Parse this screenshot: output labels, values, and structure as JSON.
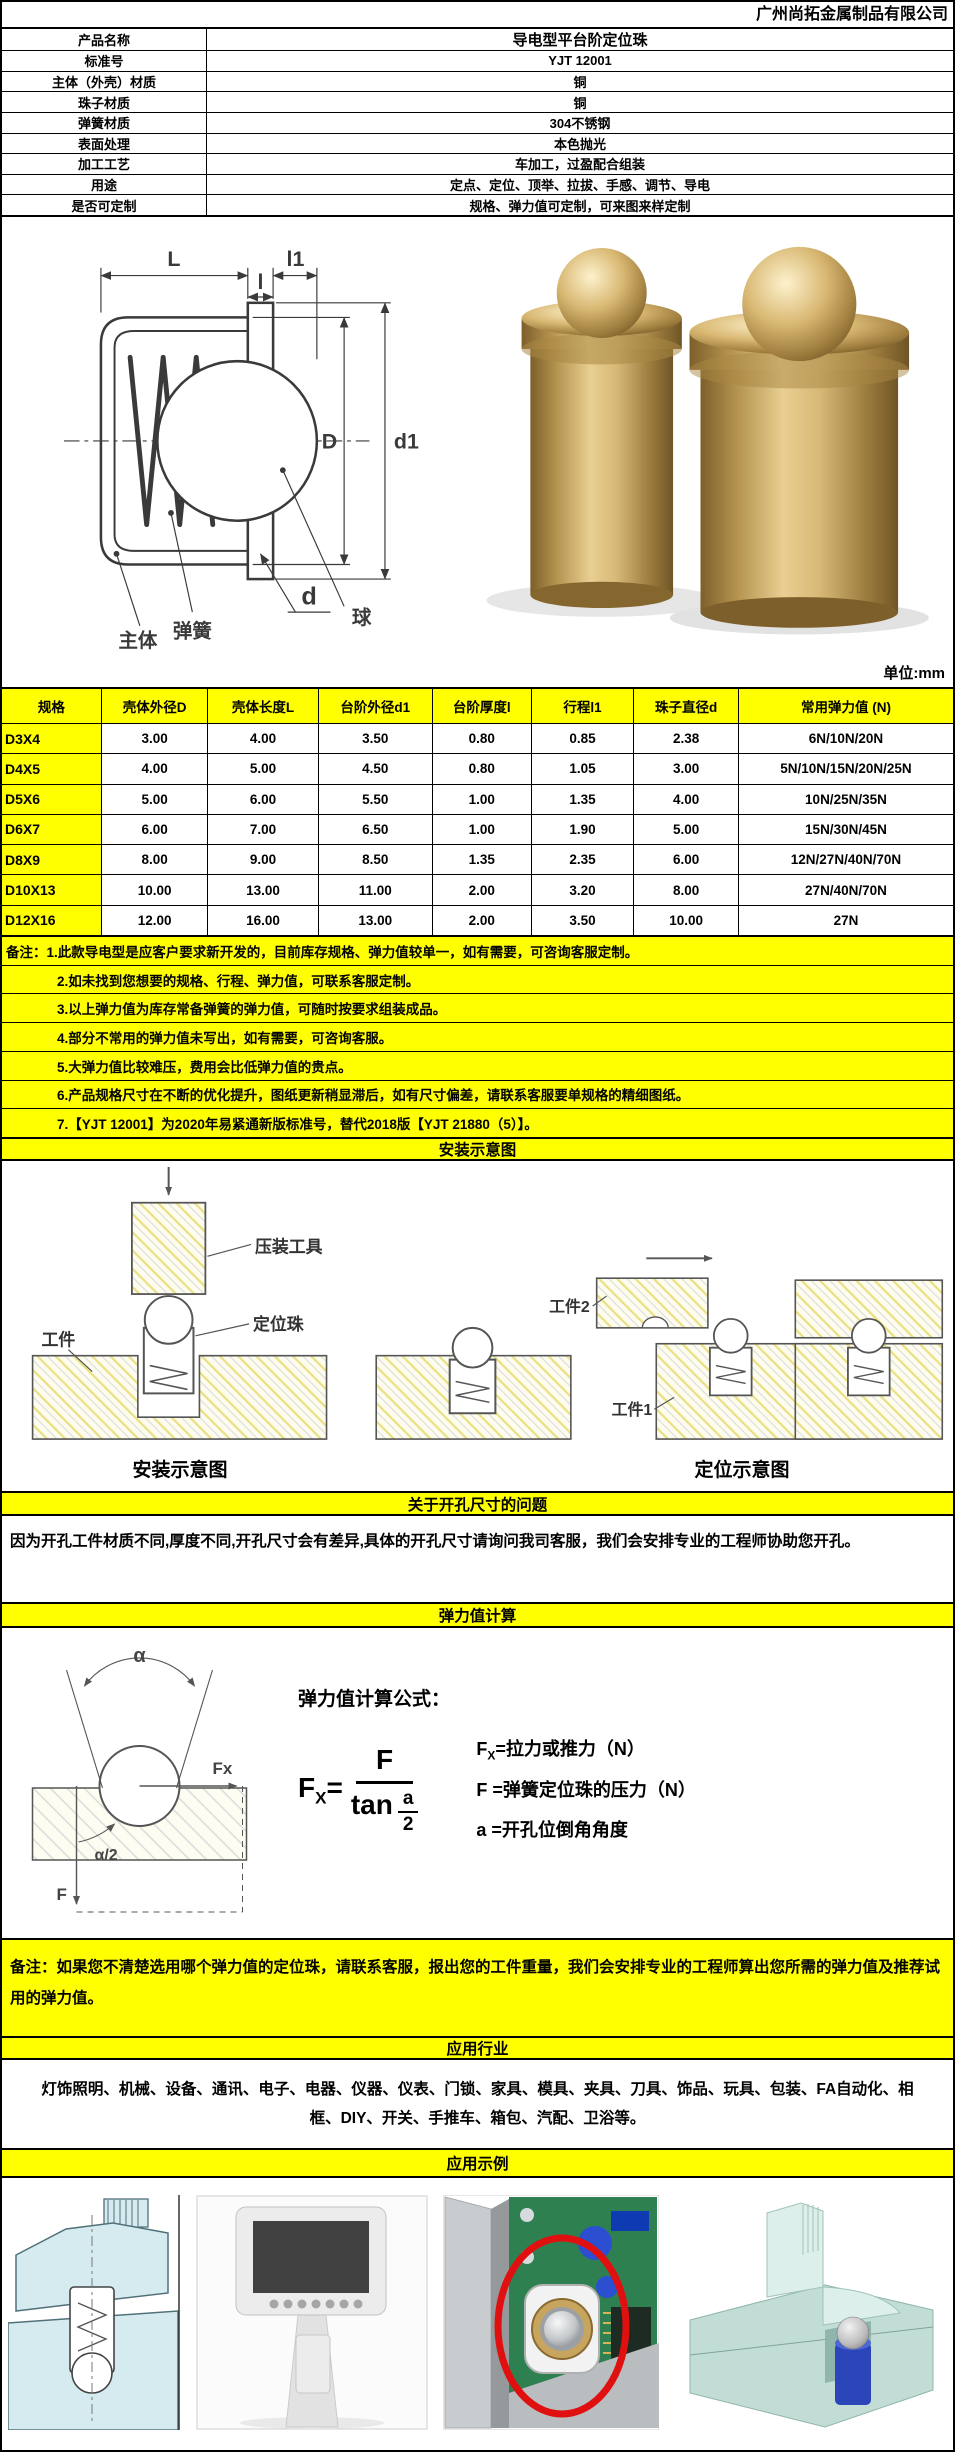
{
  "page": {
    "company": "广州尚拓金属制品有限公司",
    "unit_note": "单位:mm"
  },
  "spec": {
    "rows": [
      {
        "label": "产品名称",
        "value": "导电型平台阶定位珠"
      },
      {
        "label": "标准号",
        "value": "YJT 12001"
      },
      {
        "label": "主体（外壳）材质",
        "value": "铜"
      },
      {
        "label": "珠子材质",
        "value": "铜"
      },
      {
        "label": "弹簧材质",
        "value": "304不锈钢"
      },
      {
        "label": "表面处理",
        "value": "本色抛光"
      },
      {
        "label": "加工工艺",
        "value": "车加工，过盈配合组装"
      },
      {
        "label": "用途",
        "value": "定点、定位、顶举、拉拔、手感、调节、导电"
      },
      {
        "label": "是否可定制",
        "value": "规格、弹力值可定制，可来图来样定制"
      }
    ]
  },
  "drawing": {
    "dim_L": "L",
    "dim_l1": "l1",
    "dim_l": "l",
    "dim_D": "D",
    "dim_d1": "d1",
    "dim_d": "d",
    "label_spring": "弹簧",
    "label_ball": "球",
    "label_body": "主体"
  },
  "size_table": {
    "headers": [
      "规格",
      "壳体外径D",
      "壳体长度L",
      "台阶外径d1",
      "台阶厚度l",
      "行程l1",
      "珠子直径d",
      "常用弹力值 (N)"
    ],
    "rows": [
      [
        "D3X4",
        "3.00",
        "4.00",
        "3.50",
        "0.80",
        "0.85",
        "2.38",
        "6N/10N/20N"
      ],
      [
        "D4X5",
        "4.00",
        "5.00",
        "4.50",
        "0.80",
        "1.05",
        "3.00",
        "5N/10N/15N/20N/25N"
      ],
      [
        "D5X6",
        "5.00",
        "6.00",
        "5.50",
        "1.00",
        "1.35",
        "4.00",
        "10N/25N/35N"
      ],
      [
        "D6X7",
        "6.00",
        "7.00",
        "6.50",
        "1.00",
        "1.90",
        "5.00",
        "15N/30N/45N"
      ],
      [
        "D8X9",
        "8.00",
        "9.00",
        "8.50",
        "1.35",
        "2.35",
        "6.00",
        "12N/27N/40N/70N"
      ],
      [
        "D10X13",
        "10.00",
        "13.00",
        "11.00",
        "2.00",
        "3.20",
        "8.00",
        "27N/40N/70N"
      ],
      [
        "D12X16",
        "12.00",
        "16.00",
        "13.00",
        "2.00",
        "3.50",
        "10.00",
        "27N"
      ]
    ]
  },
  "notes": {
    "lines": [
      "备注：1.此款导电型是应客户要求新开发的，目前库存规格、弹力值较单一，如有需要，可咨询客服定制。",
      "2.如未找到您想要的规格、行程、弹力值，可联系客服定制。",
      "3.以上弹力值为库存常备弹簧的弹力值，可随时按要求组装成品。",
      "4.部分不常用的弹力值未写出，如有需要，可咨询客服。",
      "5.大弹力值比较难压，费用会比低弹力值的贵点。",
      "6.产品规格尺寸在不断的优化提升，图纸更新稍显滞后，如有尺寸偏差，请联系客服要单规格的精细图纸。",
      "7.【YJT 12001】为2020年易紧通新版标准号，替代2018版【YJT 21880（5）】。"
    ]
  },
  "install": {
    "title": "安装示意图",
    "labels": {
      "press_tool": "压装工具",
      "workpiece": "工件",
      "plunger": "定位珠",
      "workpiece2": "工件2",
      "workpiece1": "工件1"
    },
    "caption_left": "安装示意图",
    "caption_right": "定位示意图"
  },
  "hole": {
    "title": "关于开孔尺寸的问题",
    "paragraph": "因为开孔工件材质不同,厚度不同,开孔尺寸会有差异,具体的开孔尺寸请询问我司客服，我们会安排专业的工程师协助您开孔。"
  },
  "calc": {
    "title": "弹力值计算",
    "formula_label": "弹力值计算公式：",
    "formula": {
      "lhs": "F",
      "lhs_sub": "X",
      "eq": "=",
      "numerator": "F",
      "den_fn": "tan",
      "den_top": "a",
      "den_bottom": "2"
    },
    "legend": [
      {
        "head": "F",
        "sub": "X",
        "rest": "=拉力或推力（N）"
      },
      {
        "head": "F",
        "sub": "",
        "rest": " =弹簧定位珠的压力（N）"
      },
      {
        "head": "a",
        "sub": "",
        "rest": " =开孔位倒角角度"
      }
    ],
    "diagram": {
      "alpha": "α",
      "fx": "Fx",
      "half": "α/2",
      "f": "F"
    }
  },
  "remark": {
    "text": "备注：如果您不清楚选用哪个弹力值的定位珠，请联系客服，报出您的工件重量，我们会安排专业的工程师算出您所需的弹力值及推荐试用的弹力值。"
  },
  "industries": {
    "title": "应用行业",
    "text": "灯饰照明、机械、设备、通讯、电子、电器、仪器、仪表、门锁、家具、模具、夹具、刀具、饰品、玩具、包装、FA自动化、相框、DIY、开关、手推车、箱包、汽配、卫浴等。"
  },
  "examples": {
    "title": "应用示例"
  },
  "colors": {
    "accent_yellow": "#FFFF00",
    "brass": "#C9A45C",
    "pcb_green": "#2E8050",
    "highlight_red": "#E01010"
  }
}
